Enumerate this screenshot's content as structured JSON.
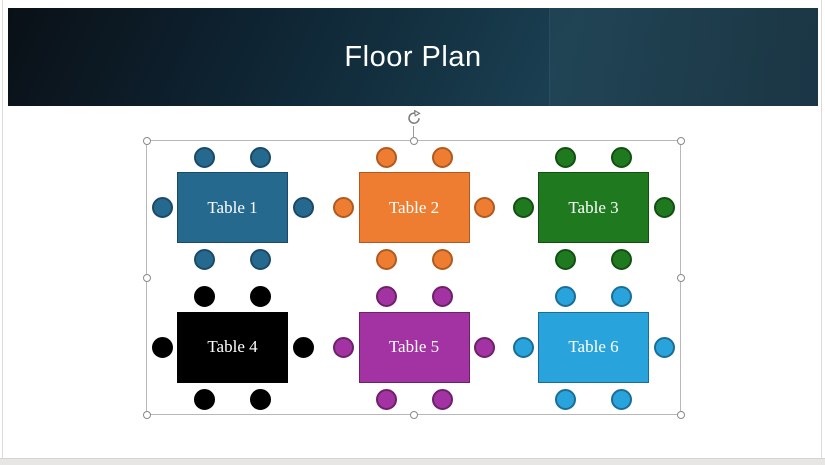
{
  "slide": {
    "title": "Floor Plan",
    "title_color": "#ffffff",
    "band_colors": {
      "left": "#0a1016",
      "mid": "#143343",
      "right": "#1a3f51"
    }
  },
  "floor_plan": {
    "tables": [
      {
        "label": "Table 1",
        "fill": "#26698F",
        "stroke": "#1B4A66"
      },
      {
        "label": "Table 2",
        "fill": "#EE7D31",
        "stroke": "#AE5A21"
      },
      {
        "label": "Table 3",
        "fill": "#1F7A1F",
        "stroke": "#134F13"
      },
      {
        "label": "Table 4",
        "fill": "#000000",
        "stroke": "#000000"
      },
      {
        "label": "Table 5",
        "fill": "#A333A3",
        "stroke": "#6D2169"
      },
      {
        "label": "Table 6",
        "fill": "#29A3DC",
        "stroke": "#1A6E96"
      }
    ],
    "chairs_per_table": 6
  },
  "selection": {
    "border_color": "#b8b8b8",
    "handle_fill": "#ffffff",
    "handle_stroke": "#8a8a8a",
    "rotate_icon_color": "#7a7a7a"
  },
  "window": {
    "bottom_strip_color": "#e8e5e5"
  }
}
